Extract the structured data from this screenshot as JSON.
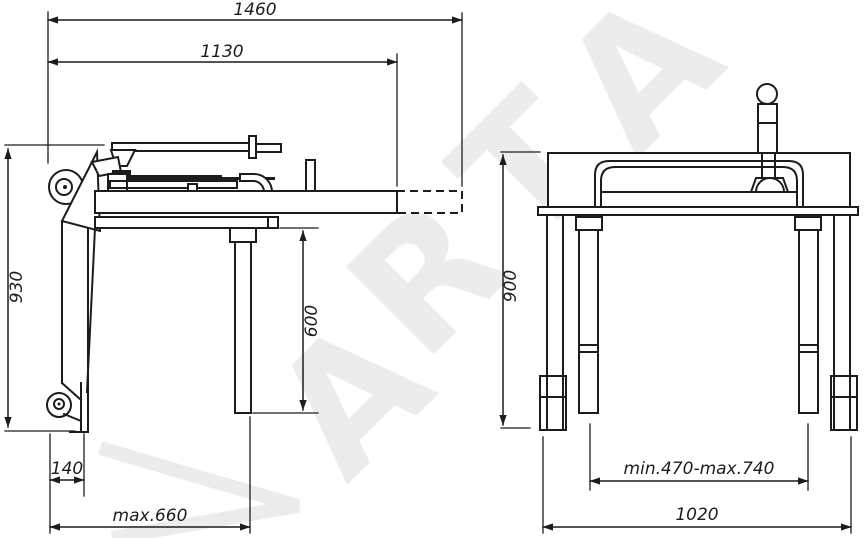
{
  "watermark": {
    "letters": [
      "A",
      "R",
      "T",
      "A"
    ]
  },
  "side_view": {
    "overall_length": "1460",
    "platform_length": "1130",
    "overall_height": "930",
    "leg_clearance": "600",
    "caster_offset": "140",
    "base_depth": "max.660"
  },
  "front_view": {
    "overall_height": "900",
    "leg_spread": "min.470-max.740",
    "overall_width": "1020"
  }
}
